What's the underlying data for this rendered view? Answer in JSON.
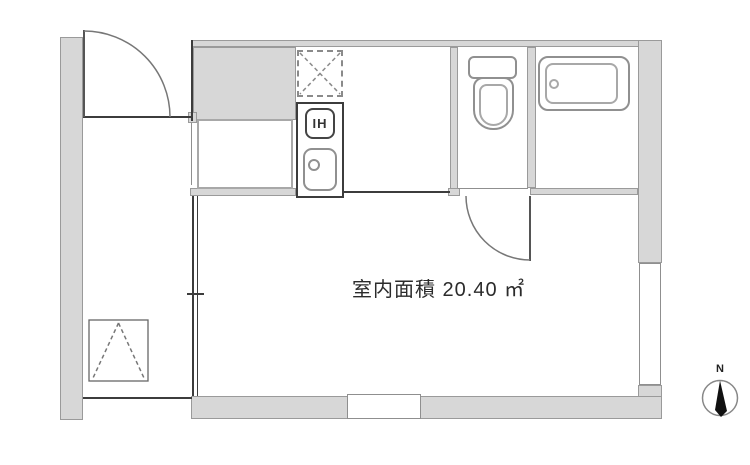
{
  "floor_plan": {
    "area_text": "室内面積 20.40 ㎡",
    "kitchen": {
      "stove_label": "IH"
    },
    "compass": {
      "north_label": "N"
    },
    "icons": {
      "washing_machine_pan": "dashed-square-x",
      "escape_hatch": "dashed-square-peak",
      "compass_needle": "north-arrow"
    },
    "colors": {
      "wall_fill": "#d7d7d7",
      "wall_outline": "#9a9a9a",
      "dark_line": "#3c3c3c",
      "fixture_outline": "#909090",
      "needle_fill": "#111111"
    }
  }
}
